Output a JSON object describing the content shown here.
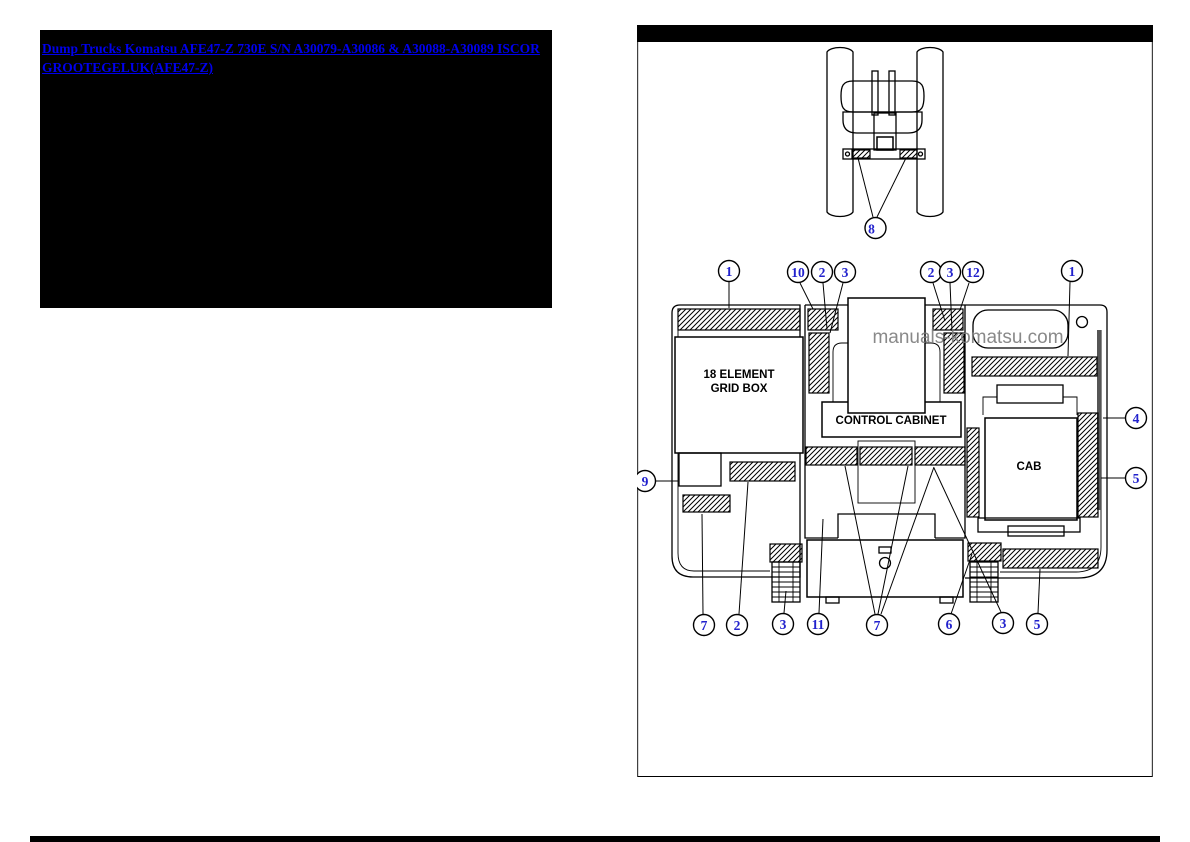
{
  "link": {
    "lines": [
      "Dump Trucks Komatsu AFE47-Z 730E S/N A30079-A30086 & A30088-A30089 ISCOR",
      "GROOTEGELUK(AFE47-Z)"
    ]
  },
  "watermark": "manuals-komatsu.com",
  "diagram": {
    "grid_box": [
      "18 ELEMENT",
      "GRID BOX"
    ],
    "control_cabinet": "CONTROL CABINET",
    "cab": "CAB"
  },
  "callouts": {
    "front_view": [
      "8"
    ],
    "top": [
      "1",
      "10",
      "2",
      "3",
      "2",
      "3",
      "12",
      "1"
    ],
    "left": [
      "9"
    ],
    "right": [
      "4",
      "5"
    ],
    "bottom": [
      "7",
      "2",
      "3",
      "11",
      "7",
      "6",
      "3",
      "5"
    ]
  },
  "colors": {
    "link_blue": "#0000EE",
    "callout_blue": "#2121CD",
    "watermark_gray": "#7D7D7D",
    "line_black": "#000000",
    "panel_bar_black": "#000000"
  }
}
